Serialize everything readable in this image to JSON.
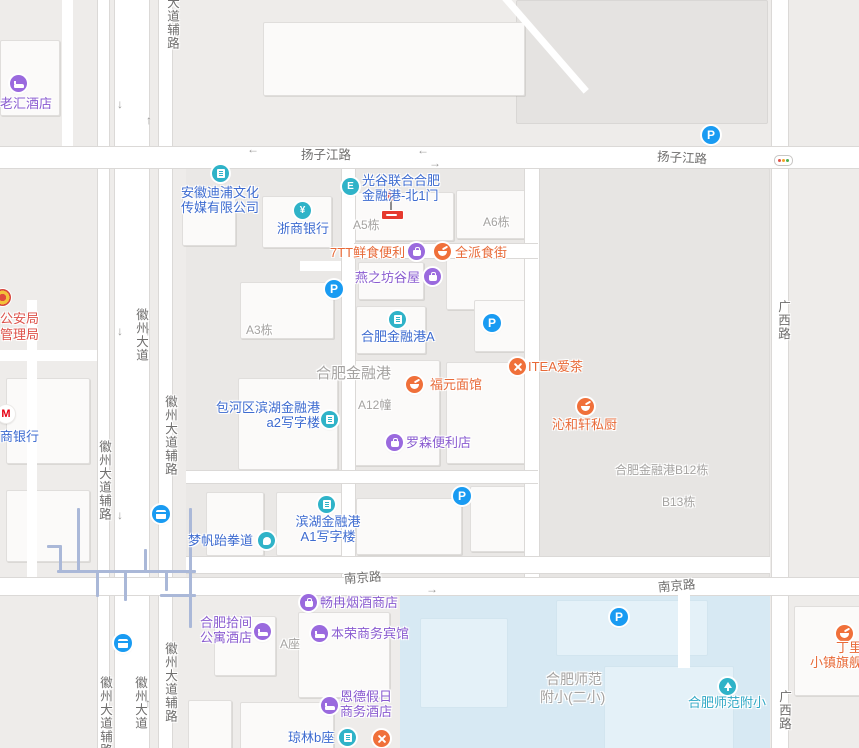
{
  "colors": {
    "poi_blue": "#3d6bd0",
    "poi_purple": "#8a5cd0",
    "poi_orange": "#e86a38",
    "poi_teal": "#2fb3c8",
    "parking_blue": "#199bf2",
    "gov_red": "#dd5149",
    "marker_red": "#e6392e",
    "school_area_blue": "#d7e9f3"
  },
  "roads": {
    "yangzijiang": "扬子江路",
    "nanjing": "南京路",
    "guangxi": "广西路",
    "huizhou": "徽州大道",
    "huizhou_side": "徽州大道辅路",
    "side_clipped": "大道辅路"
  },
  "areas": {
    "complex": "合肥金融港",
    "school_line1": "合肥师范",
    "school_line2": "附小(二小)"
  },
  "buildings": {
    "a5": "A5栋",
    "a6": "A6栋",
    "a3": "A3栋",
    "a12": "A12幢",
    "b12": "合肥金融港B12栋",
    "b13": "B13栋",
    "azuo": "A座"
  },
  "pois": {
    "laohui": {
      "label": "老汇酒店"
    },
    "dipu": {
      "line1": "安徽迪浦文化",
      "line2": "传媒有限公司"
    },
    "zheshang": {
      "label": "浙商银行"
    },
    "guanggu": {
      "line1": "光谷联合合肥",
      "line2": "金融港-北1门"
    },
    "qtt": {
      "label": "7TT鲜食便利"
    },
    "quanpai": {
      "label": "全派食街"
    },
    "yanzhifang": {
      "label": "燕之坊谷屋"
    },
    "jrga": {
      "label": "合肥金融港A"
    },
    "fuyuan": {
      "label": "福元面馆"
    },
    "itea": {
      "label": "ITEA爱茶"
    },
    "qinhexuan": {
      "label": "沁和轩私厨"
    },
    "a2": {
      "line1": "包河区滨湖金融港",
      "line2": "a2写字楼"
    },
    "lawson": {
      "label": "罗森便利店"
    },
    "a1": {
      "line1": "滨湖金融港",
      "line2": "A1写字楼"
    },
    "mengfan": {
      "label": "梦帆跆拳道"
    },
    "police": {
      "line1": "公安局",
      "line2": "管理局"
    },
    "cmb": {
      "label": "商银行"
    },
    "changran": {
      "label": "畅冉烟酒商店"
    },
    "shijian": {
      "line1": "合肥拾间",
      "line2": "公寓酒店"
    },
    "benrong": {
      "label": "本荣商务宾馆"
    },
    "ende": {
      "line1": "恩德假日",
      "line2": "商务酒店"
    },
    "qionglin": {
      "label": "琼林b座"
    },
    "shifan": {
      "label": "合肥师范附小"
    },
    "dingliyang": {
      "line1": "丁里羊",
      "line2": "小镇旗舰店"
    }
  },
  "icons": {
    "parking": "P",
    "entrance": "E",
    "yuan": "¥",
    "cmb_m": "M"
  },
  "arrows": {
    "up": "↑",
    "down": "↓",
    "left": "←",
    "right": "→"
  }
}
